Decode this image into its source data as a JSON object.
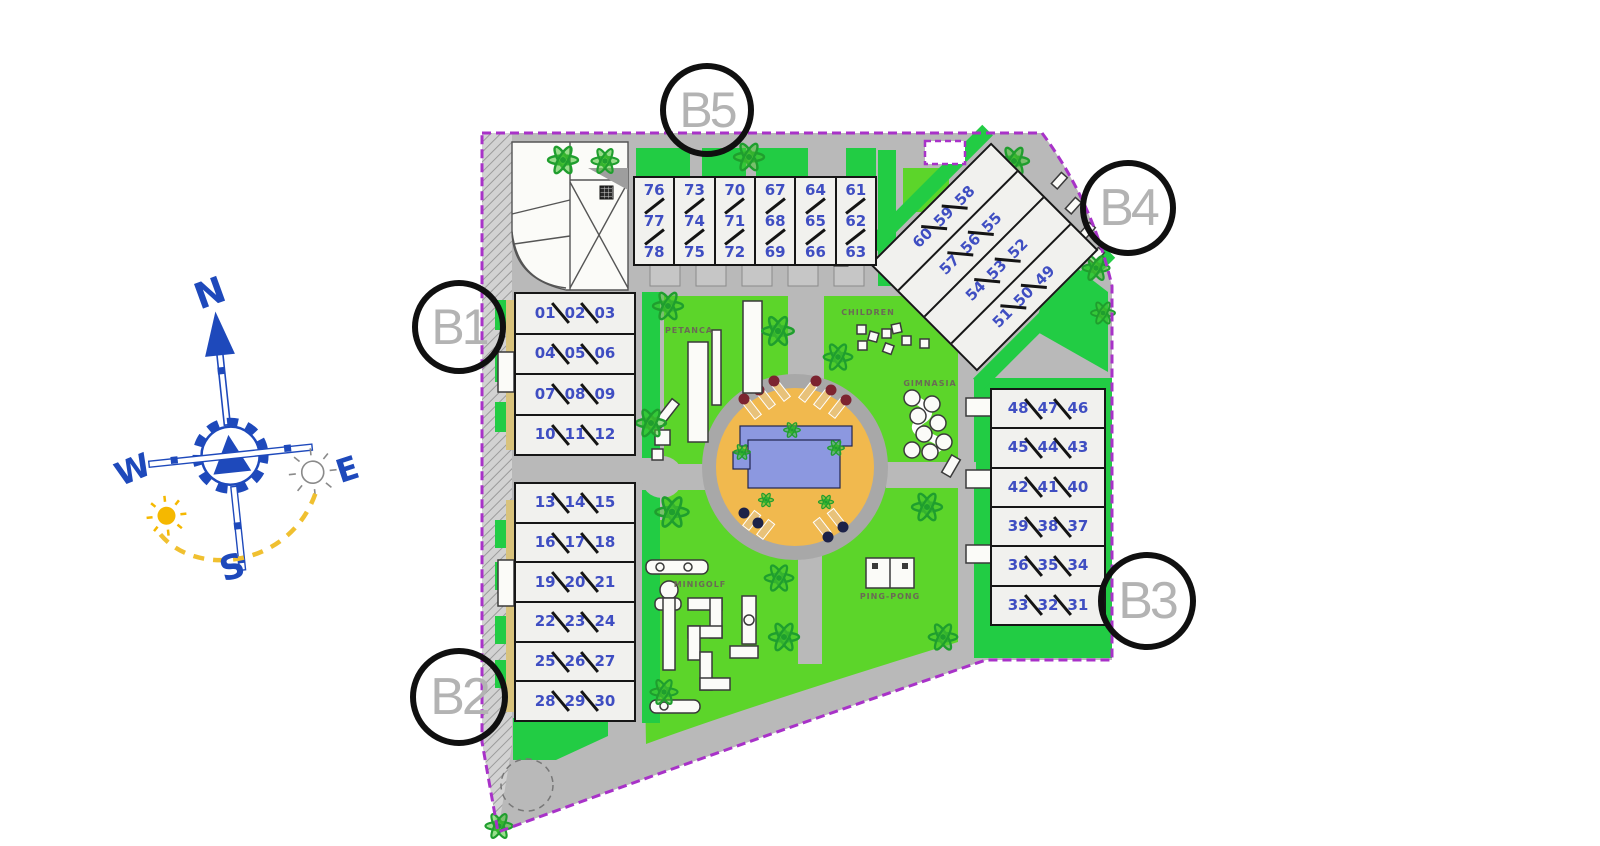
{
  "compass": {
    "n": "N",
    "e": "E",
    "s": "S",
    "w": "W"
  },
  "blocks": {
    "b1": {
      "label": "B1",
      "rows": [
        [
          "01",
          "02",
          "03"
        ],
        [
          "04",
          "05",
          "06"
        ],
        [
          "07",
          "08",
          "09"
        ],
        [
          "10",
          "11",
          "12"
        ]
      ]
    },
    "b2": {
      "label": "B2",
      "rows": [
        [
          "13",
          "14",
          "15"
        ],
        [
          "16",
          "17",
          "18"
        ],
        [
          "19",
          "20",
          "21"
        ],
        [
          "22",
          "23",
          "24"
        ],
        [
          "25",
          "26",
          "27"
        ],
        [
          "28",
          "29",
          "30"
        ]
      ]
    },
    "b3": {
      "label": "B3",
      "rows": [
        [
          "48",
          "47",
          "46"
        ],
        [
          "45",
          "44",
          "43"
        ],
        [
          "42",
          "41",
          "40"
        ],
        [
          "39",
          "38",
          "37"
        ],
        [
          "36",
          "35",
          "34"
        ],
        [
          "33",
          "32",
          "31"
        ]
      ]
    },
    "b4": {
      "label": "B4",
      "rows": [
        [
          "60",
          "59",
          "58"
        ],
        [
          "57",
          "56",
          "55"
        ],
        [
          "54",
          "53",
          "52"
        ],
        [
          "51",
          "50",
          "49"
        ]
      ]
    },
    "b5": {
      "label": "B5",
      "cols": [
        [
          "76",
          "77",
          "78"
        ],
        [
          "73",
          "74",
          "75"
        ],
        [
          "70",
          "71",
          "72"
        ],
        [
          "67",
          "68",
          "69"
        ],
        [
          "64",
          "65",
          "66"
        ],
        [
          "61",
          "62",
          "63"
        ]
      ]
    }
  },
  "amenities": {
    "petanca": "PETANCA",
    "children": "CHILDREN",
    "gimnasia": "GIMNASIA",
    "minigolf": "MINIGOLF",
    "pingpong": "PING-PONG"
  },
  "colors": {
    "boundary": "#a832c8",
    "road": "#b9b9b9",
    "lawn": "#5cd52a",
    "garden": "#22cc44",
    "pool_deck": "#f1b94e",
    "pool_water": "#8c98e0",
    "unit_number": "#3f4ec2",
    "compass": "#1e49bb",
    "sun": "#f5b800",
    "label_gray": "#b3b3b3"
  }
}
